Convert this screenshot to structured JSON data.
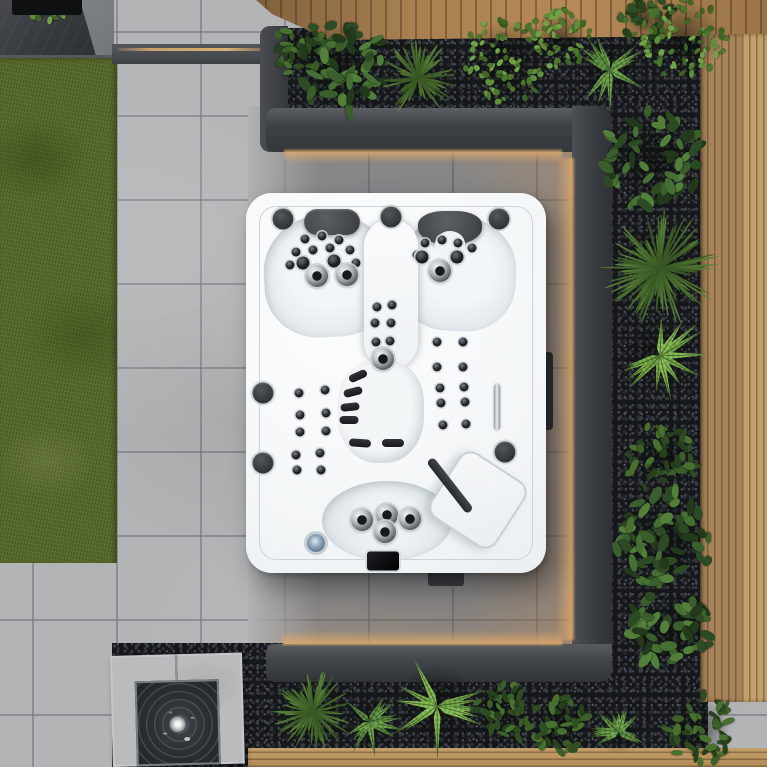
{
  "scene": {
    "type": "aerial-photo",
    "subject": "Top-down view of a white rectangular hot tub with black hydrotherapy jets and two dark headrests",
    "setting": "Modern garden patio with grey porcelain tiles, artificial grass strip, charcoal raised planters, black pebble mulch beds with shrubs ferns and grasses, timber decking borders, a square bubbling water feature, and warm LED strip lighting around the recessed spa area"
  },
  "palette": {
    "tile": "#b2b4b6",
    "tile_line": "#9a9da0",
    "grass": "#57692a",
    "charcoal": "#383c40",
    "pebble": "#15171a",
    "wood": "#a87f4f",
    "wood_light": "#c3a06c",
    "tub_white": "#f6f8f9",
    "jet_black": "#1d2023",
    "headrest": "#4b4f54",
    "led_warm": "#e6ac6a",
    "led_blue": "#8ea6ba",
    "water_dark": "#2b3033",
    "splash_white": "#f2f4f4"
  },
  "plants": [
    {
      "x": 300,
      "y": 50,
      "r": 30,
      "type": "shrub"
    },
    {
      "x": 340,
      "y": 66,
      "r": 50,
      "type": "laurel"
    },
    {
      "x": 418,
      "y": 78,
      "r": 40,
      "type": "grass"
    },
    {
      "x": 505,
      "y": 60,
      "r": 48,
      "type": "boxwood"
    },
    {
      "x": 560,
      "y": 38,
      "r": 34,
      "type": "boxwood"
    },
    {
      "x": 610,
      "y": 70,
      "r": 40,
      "type": "fern-mid"
    },
    {
      "x": 645,
      "y": 18,
      "r": 28,
      "type": "shrub"
    },
    {
      "x": 683,
      "y": 38,
      "r": 46,
      "type": "boxwood"
    },
    {
      "x": 652,
      "y": 160,
      "r": 54,
      "type": "laurel"
    },
    {
      "x": 660,
      "y": 268,
      "r": 60,
      "type": "grass"
    },
    {
      "x": 660,
      "y": 356,
      "r": 48,
      "type": "fern"
    },
    {
      "x": 662,
      "y": 458,
      "r": 38,
      "type": "shrub"
    },
    {
      "x": 664,
      "y": 540,
      "r": 54,
      "type": "laurel"
    },
    {
      "x": 670,
      "y": 630,
      "r": 44,
      "type": "laurel"
    },
    {
      "x": 700,
      "y": 728,
      "r": 38,
      "type": "shrub"
    },
    {
      "x": 313,
      "y": 712,
      "r": 42,
      "type": "grass"
    },
    {
      "x": 370,
      "y": 722,
      "r": 34,
      "type": "fern-mid"
    },
    {
      "x": 437,
      "y": 706,
      "r": 52,
      "type": "fern"
    },
    {
      "x": 502,
      "y": 712,
      "r": 34,
      "type": "shrub"
    },
    {
      "x": 560,
      "y": 724,
      "r": 32,
      "type": "shrub"
    },
    {
      "x": 618,
      "y": 732,
      "r": 28,
      "type": "fern-mid"
    },
    {
      "x": 46,
      "y": 2,
      "r": 22,
      "type": "boxwood"
    }
  ],
  "hot_tub": {
    "x": 246,
    "y": 193,
    "w": 300,
    "h": 380,
    "jets": [
      {
        "t": "spk",
        "x": 37,
        "y": 26
      },
      {
        "t": "spk",
        "x": 145,
        "y": 24
      },
      {
        "t": "spk",
        "x": 253,
        "y": 26
      },
      {
        "t": "spk",
        "x": 17,
        "y": 200
      },
      {
        "t": "spk",
        "x": 17,
        "y": 270
      },
      {
        "t": "spk",
        "x": 259,
        "y": 259
      },
      {
        "t": "s",
        "x": 59,
        "y": 46
      },
      {
        "t": "s",
        "x": 76,
        "y": 43
      },
      {
        "t": "s",
        "x": 93,
        "y": 47
      },
      {
        "t": "s",
        "x": 50,
        "y": 59
      },
      {
        "t": "s",
        "x": 67,
        "y": 57
      },
      {
        "t": "s",
        "x": 84,
        "y": 55
      },
      {
        "t": "s",
        "x": 104,
        "y": 57
      },
      {
        "t": "s",
        "x": 44,
        "y": 72
      },
      {
        "t": "s",
        "x": 110,
        "y": 70
      },
      {
        "t": "m",
        "x": 57,
        "y": 70
      },
      {
        "t": "m",
        "x": 88,
        "y": 68
      },
      {
        "t": "L",
        "x": 71,
        "y": 83
      },
      {
        "t": "L",
        "x": 101,
        "y": 82
      },
      {
        "t": "s",
        "x": 179,
        "y": 50
      },
      {
        "t": "s",
        "x": 196,
        "y": 47
      },
      {
        "t": "s",
        "x": 212,
        "y": 50
      },
      {
        "t": "s",
        "x": 226,
        "y": 55
      },
      {
        "t": "s",
        "x": 171,
        "y": 62
      },
      {
        "t": "m",
        "x": 176,
        "y": 64
      },
      {
        "t": "m",
        "x": 211,
        "y": 64
      },
      {
        "t": "L",
        "x": 194,
        "y": 78
      },
      {
        "t": "s",
        "x": 131,
        "y": 114
      },
      {
        "t": "s",
        "x": 146,
        "y": 112
      },
      {
        "t": "s",
        "x": 129,
        "y": 130
      },
      {
        "t": "s",
        "x": 145,
        "y": 130
      },
      {
        "t": "s",
        "x": 130,
        "y": 149
      },
      {
        "t": "s",
        "x": 144,
        "y": 148
      },
      {
        "t": "L",
        "x": 137,
        "y": 166
      },
      {
        "t": "pad",
        "x": 112,
        "y": 183,
        "a": -24
      },
      {
        "t": "pad",
        "x": 107,
        "y": 199,
        "a": -14
      },
      {
        "t": "pad",
        "x": 104,
        "y": 214,
        "a": -6
      },
      {
        "t": "pad",
        "x": 103,
        "y": 227,
        "a": 0
      },
      {
        "t": "pad",
        "x": 114,
        "y": 250,
        "a": 4,
        "w": 22
      },
      {
        "t": "pad",
        "x": 147,
        "y": 250,
        "a": 0,
        "w": 22
      },
      {
        "t": "s",
        "x": 191,
        "y": 149
      },
      {
        "t": "s",
        "x": 217,
        "y": 149
      },
      {
        "t": "s",
        "x": 191,
        "y": 174
      },
      {
        "t": "s",
        "x": 217,
        "y": 174
      },
      {
        "t": "s",
        "x": 194,
        "y": 195
      },
      {
        "t": "s",
        "x": 218,
        "y": 194
      },
      {
        "t": "s",
        "x": 195,
        "y": 210
      },
      {
        "t": "s",
        "x": 219,
        "y": 209
      },
      {
        "t": "s",
        "x": 197,
        "y": 232
      },
      {
        "t": "s",
        "x": 220,
        "y": 231
      },
      {
        "t": "s",
        "x": 53,
        "y": 200
      },
      {
        "t": "s",
        "x": 79,
        "y": 197
      },
      {
        "t": "s",
        "x": 54,
        "y": 222
      },
      {
        "t": "s",
        "x": 80,
        "y": 220
      },
      {
        "t": "s",
        "x": 54,
        "y": 239
      },
      {
        "t": "s",
        "x": 80,
        "y": 238
      },
      {
        "t": "s",
        "x": 50,
        "y": 262
      },
      {
        "t": "s",
        "x": 74,
        "y": 260
      },
      {
        "t": "s",
        "x": 51,
        "y": 277
      },
      {
        "t": "s",
        "x": 75,
        "y": 277
      },
      {
        "t": "L",
        "x": 116,
        "y": 327
      },
      {
        "t": "L",
        "x": 141,
        "y": 322
      },
      {
        "t": "L",
        "x": 164,
        "y": 326
      },
      {
        "t": "L",
        "x": 139,
        "y": 339
      },
      {
        "t": "led",
        "x": 70,
        "y": 350
      },
      {
        "t": "ctrl",
        "x": 137,
        "y": 368,
        "w": 32,
        "h": 19
      },
      {
        "t": "handle",
        "x": 251,
        "y": 214,
        "w": 6,
        "h": 46
      }
    ]
  },
  "water_feature": {
    "x": 110,
    "y": 656,
    "w": 132,
    "h": 111
  }
}
